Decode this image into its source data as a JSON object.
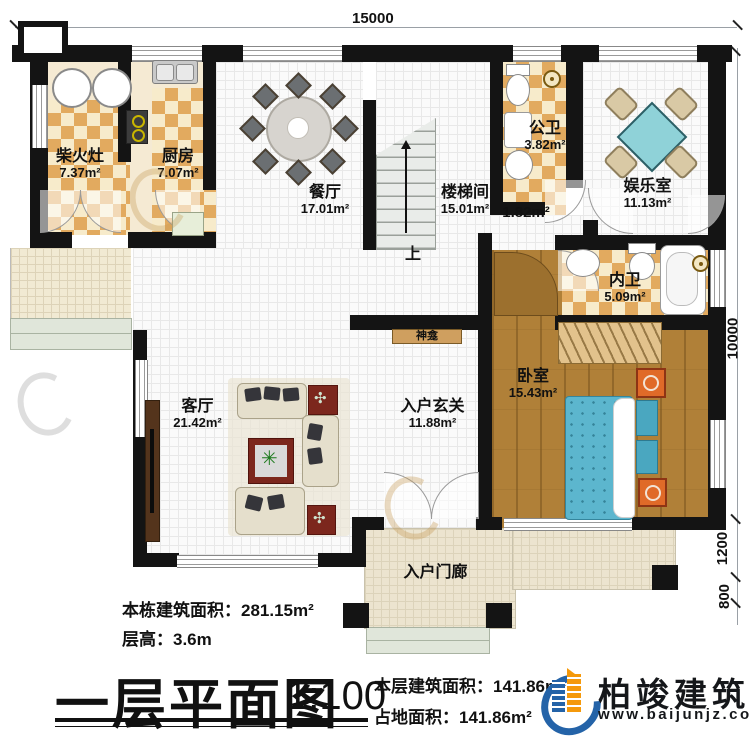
{
  "dimensions": {
    "top": "15000",
    "right_main": "10000",
    "right_mid": "1200",
    "right_small": "800"
  },
  "rooms": {
    "chaihuozao": {
      "name": "柴火灶",
      "area": "7.37m²"
    },
    "kitchen": {
      "name": "厨房",
      "area": "7.07m²"
    },
    "dining": {
      "name": "餐厅",
      "area": "17.01m²"
    },
    "stair": {
      "name": "楼梯间",
      "area": "15.01m²"
    },
    "hall": {
      "area": "1.82m²"
    },
    "pubbath": {
      "name": "公卫",
      "area": "3.82m²"
    },
    "fun": {
      "name": "娱乐室",
      "area": "11.13m²"
    },
    "inbath": {
      "name": "内卫",
      "area": "5.09m²"
    },
    "bedroom": {
      "name": "卧室",
      "area": "15.43m²"
    },
    "living": {
      "name": "客厅",
      "area": "21.42m²"
    },
    "foyer": {
      "name": "入户玄关",
      "area": "11.88m²"
    },
    "porch": {
      "name": "入户门廊"
    }
  },
  "annotations": {
    "shrine": "神龛",
    "up": "上"
  },
  "stats": {
    "building_total_label": "本栋建筑面积：",
    "building_total": "281.15m²",
    "floor_height_label": "层高：",
    "floor_height": "3.6m",
    "floor_area_label": "本层建筑面积：",
    "floor_area": "141.86m²",
    "footprint_label": "占地面积：",
    "footprint": "141.86m²"
  },
  "title": {
    "main": "一层平面图",
    "scale": "1:100"
  },
  "brand": {
    "name": "柏竣建筑",
    "site": "www.baijunjz.com"
  },
  "watermark": {
    "name": "柏竣建筑",
    "site": "www.baijunjz.com"
  },
  "colors": {
    "accent_blue": "#2463a8",
    "accent_orange": "#f5990b",
    "wall": "#141414",
    "bed_blue": "#5cb6ce",
    "table_teal": "#8fd2d8"
  }
}
